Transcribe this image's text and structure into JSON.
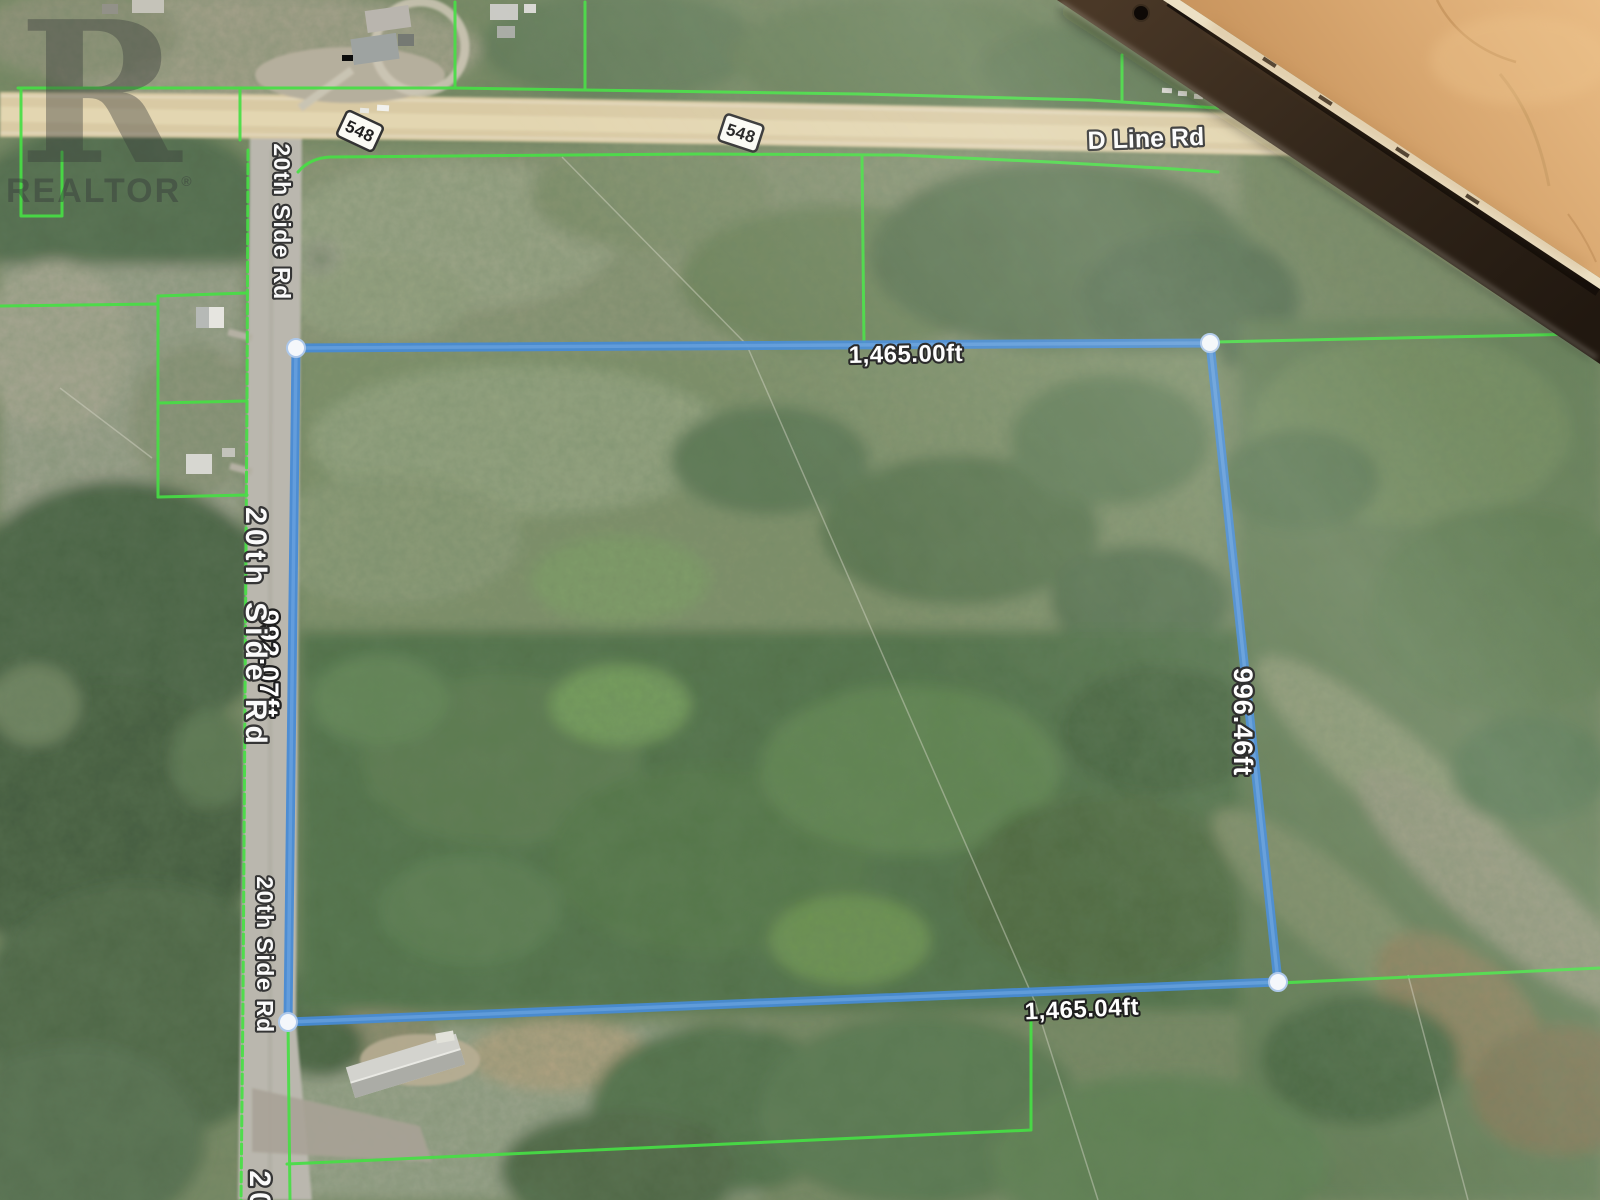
{
  "watermark": {
    "letter": "R",
    "label": "REALTOR",
    "registered": "®"
  },
  "route_shields": [
    {
      "label": "548"
    },
    {
      "label": "548"
    }
  ],
  "road_labels": {
    "main": "D Line Rd",
    "side_1": "20th Side Rd",
    "side_2": "20th Side Rd",
    "side_3": "20th Side Rd",
    "side_4_partial": "20"
  },
  "measurements": {
    "top_edge": "1,465.00ft",
    "right_edge": "996.46ft",
    "bottom_edge": "1,465.04ft",
    "left_edge": "992.07ft"
  },
  "colors": {
    "measure_line": "#3e86d3",
    "measure_line_highlight": "#6fa8e4",
    "vertex_fill": "#f5f8fc",
    "parcel_line": "#3ede3c",
    "highway_fill": "#d9c9a1",
    "side_road_fill": "#b8b5ab",
    "bezel": "#30251a",
    "bezel_trim": "#ece0c4",
    "leather": "#d3a068"
  }
}
